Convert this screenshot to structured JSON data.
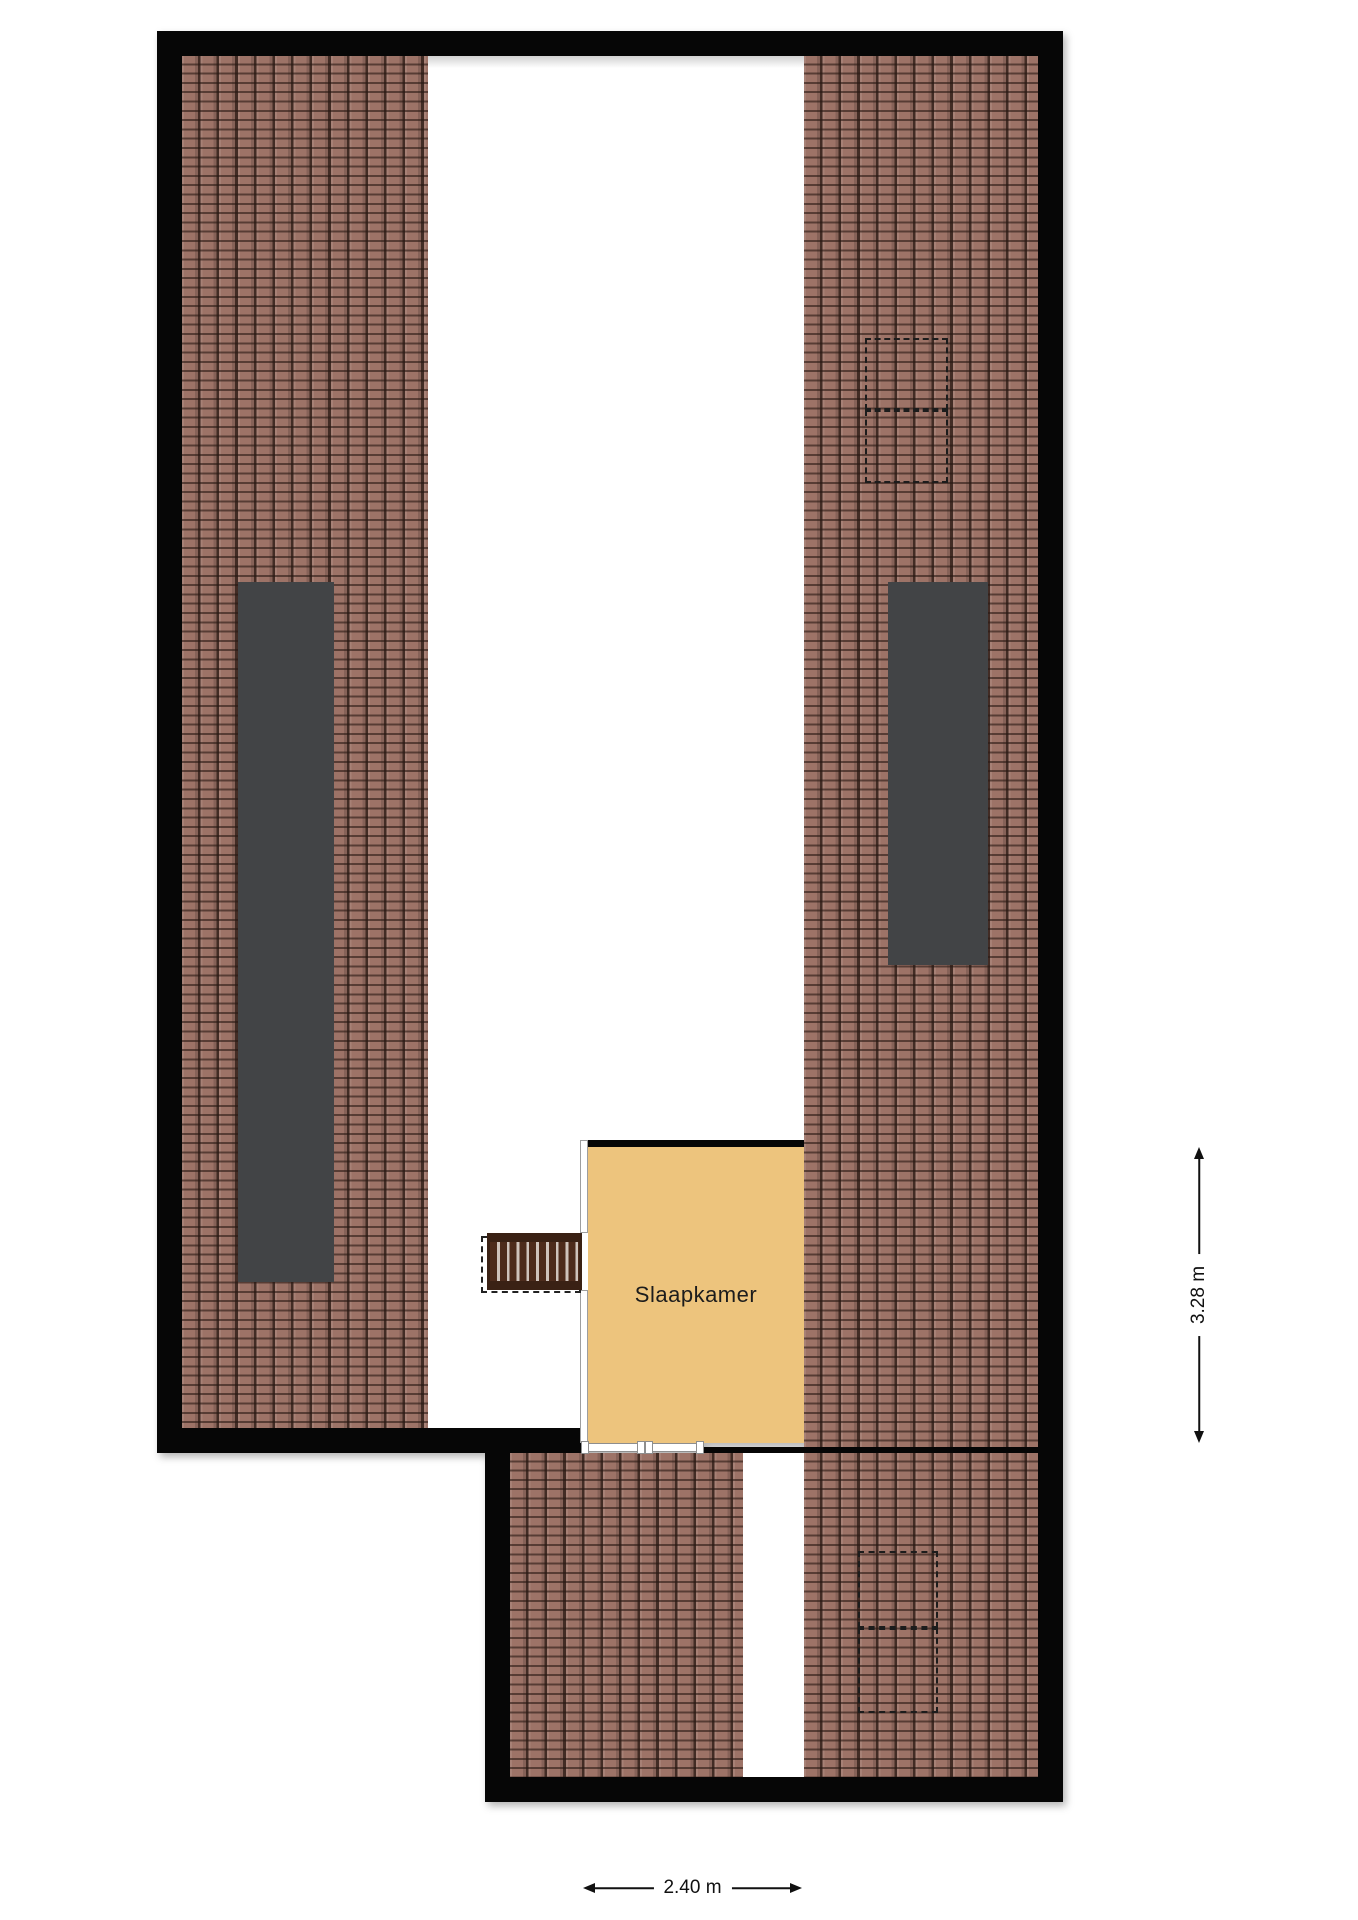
{
  "plan": {
    "type": "attic-floorplan",
    "rooms": {
      "bedroom": {
        "label": "Slaapkamer"
      }
    },
    "dimensions": {
      "width": {
        "label": "2.40 m"
      },
      "height": {
        "label": "3.28 m"
      }
    }
  },
  "colors": {
    "wall": "#060606",
    "tile_base": "#9d7367",
    "tile_line_h": "rgba(40,24,18,0.60)",
    "tile_line_v": "rgba(40,24,18,0.78)",
    "skylight": "#424446",
    "room_floor": "#edc47d",
    "stair_rail": "#3a2114",
    "stair_dark": "#4d2b1b",
    "stair_light": "#cfc3bb",
    "dim": "#111111",
    "text": "#1c1c1c"
  }
}
